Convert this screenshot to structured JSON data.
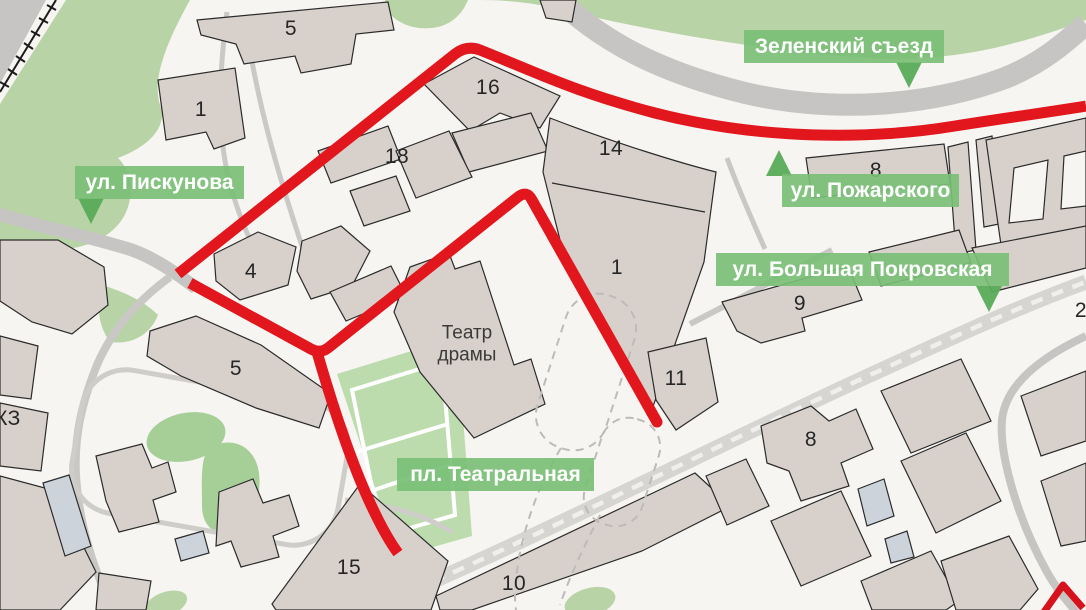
{
  "map": {
    "street_labels": {
      "zelensky_sezd": "Зеленский съезд",
      "piskunova": "ул. Пискунова",
      "pozharskogo": "ул. Пожарского",
      "bolshaya_pokrovskaya": "ул. Большая Покровская",
      "teatralnaya_square": "пл. Театральная"
    },
    "poi": {
      "theater_line1": "Театр",
      "theater_line2": "драмы"
    },
    "building_numbers": [
      "5",
      "1",
      "16",
      "18",
      "14",
      "8",
      "4",
      "1",
      "9",
      "5",
      "11",
      "8",
      "15",
      "10"
    ],
    "partial_labels": {
      "kz": "КЗ",
      "right_edge": "2"
    },
    "colors": {
      "route_red": "#e2161d",
      "label_green": "#79bf76",
      "label_pointer_green": "#58ab57",
      "park_green": "#b8d4a6",
      "square_green": "#bcdcae",
      "tree_green": "#a6cf97",
      "building_fill": "#d8d1cb",
      "building_outline": "#2b2b2b",
      "slate_building": "#ccd3da",
      "road_gray": "#c6c5c3",
      "pedestrian_street_gray": "#d6d5d2",
      "background": "#f7f5f2"
    }
  }
}
